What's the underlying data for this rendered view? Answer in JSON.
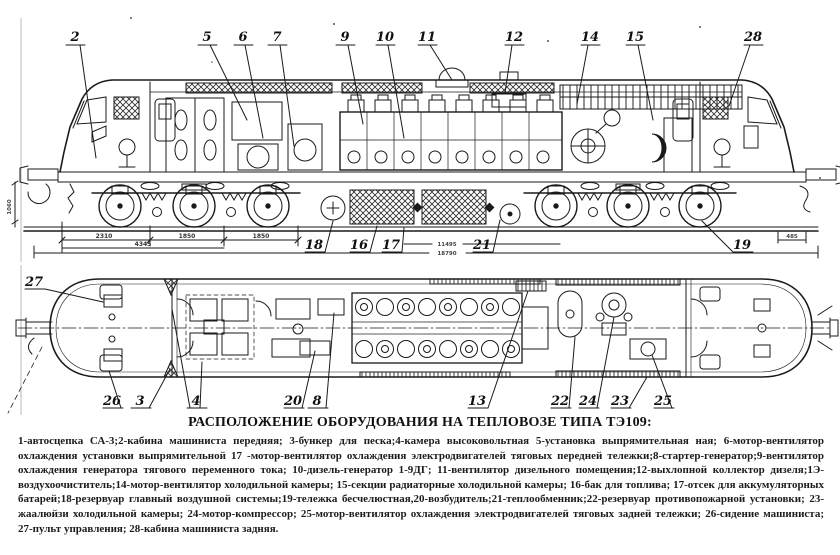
{
  "doc": {
    "title": "РАСПОЛОЖЕНИЕ ОБОРУДОВАНИЯ НА ТЕПЛОВОЗЕ ТИПА ТЭ109:",
    "legend": "1-автосцепка СА-3;2-кабина машиниста передняя; 3-бункер для песка;4-камера высоковольтная 5-установка выпрямительная ная; 6-мотор-вентилятор охлаждения установки выпрямительной 17 -мотор-вентилятор охлаждения электродвигателей тяговых передней тележки;8-стартер-генератор;9-вентилятор охлаждения генератора тягового переменного тока; 10-дизель-генератор 1-9ДГ; 11-вентилятор дизельного помещения;12-выхлопной коллектор дизеля;1Э-воздухоочиститель;14-мотор-вентилятор холодильной камеры; 15-секции радиаторные холодильной камеры; 16-бак для топлива; 17-отсек для аккумуляторных батарей;18-резервуар главный воздушной системы;19-тележка бесчелюстная,20-возбудитель;21-теплообменник;22-резервуар противопожарной установки; 23-жаалюйзи холодильной камеры; 24-мотор-компрессор; 25-мотор-вентилятор охлаждения электродвигателей тяговых задней тележки; 26-сидение машиниста; 27-пульт управления; 28-кабина машиниста задняя.",
    "colors": {
      "ink": "#1a1a1a",
      "paper": "#ffffff"
    }
  },
  "side_view": {
    "callouts": {
      "n2": "2",
      "n5": "5",
      "n6": "6",
      "n7": "7",
      "n9": "9",
      "n10": "10",
      "n11": "11",
      "n12": "12",
      "n14": "14",
      "n15": "15",
      "n28": "28",
      "n18": "18",
      "n16": "16",
      "n17": "17",
      "n21": "21",
      "n19": "19"
    },
    "dims": {
      "d2310": "2310",
      "d1850a": "1850",
      "d1850b": "1850",
      "d4345": "4345",
      "d11495": "11495",
      "d18790": "18790",
      "d485": "485",
      "d1060": "1060"
    }
  },
  "plan_view": {
    "callouts": {
      "n27": "27",
      "n26": "26",
      "n3": "3",
      "n4": "4",
      "n20": "20",
      "n8": "8",
      "n13": "13",
      "n22": "22",
      "n24": "24",
      "n23": "23",
      "n25": "25"
    }
  }
}
